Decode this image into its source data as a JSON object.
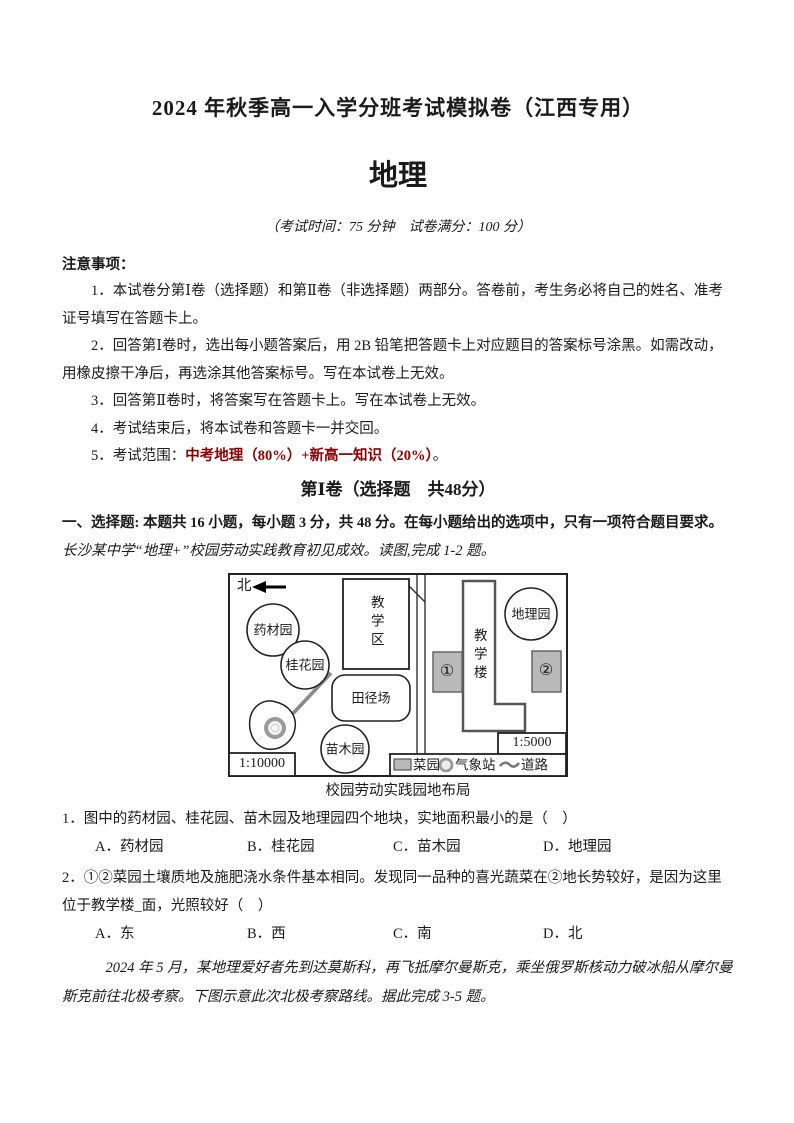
{
  "page": {
    "title": "2024 年秋季高一入学分班考试模拟卷（江西专用）",
    "subject": "地理",
    "exam_info": "（考试时间：75 分钟　试卷满分：100 分）"
  },
  "notes": {
    "heading": "注意事项：",
    "items": [
      "1．本试卷分第Ⅰ卷（选择题）和第Ⅱ卷（非选择题）两部分。答卷前，考生务必将自己的姓名、准考证号填写在答题卡上。",
      "2．回答第Ⅰ卷时，选出每小题答案后，用 2B 铅笔把答题卡上对应题目的答案标号涂黑。如需改动，用橡皮擦干净后，再选涂其他答案标号。写在本试卷上无效。",
      "3．回答第Ⅱ卷时，将答案写在答题卡上。写在本试卷上无效。",
      "4．考试结束后，将本试卷和答题卡一并交回。"
    ],
    "item5_prefix": "5．考试范围：",
    "item5_scope": "中考地理（80%）+新高一知识（20%）",
    "item5_suffix": "。",
    "scope_color": "#8b0000"
  },
  "section1": {
    "heading": "第Ⅰ卷（选择题　共48分）",
    "intro_bold": "一、选择题: 本题共 16 小题，每小题 3 分，共 48 分。在每小题给出的选项中，只有一项符合题目要求。",
    "intro_kai": "长沙某中学“地理+”校园劳动实践教育初见成效。读图,完成 1-2 题。"
  },
  "figure": {
    "caption": "校园劳动实践园地布局",
    "north_label": "北",
    "labels": {
      "yaocaiyuan": "药材园",
      "guihuayuan": "桂花园",
      "jiaoxuequ": "教学区",
      "tianjingchang": "田径场",
      "miaomuyuan": "苗木园",
      "diliyuan": "地理园",
      "jiaoxuelou": "教学楼",
      "num1": "①",
      "num2": "②",
      "scale_left": "1:10000",
      "scale_right": "1:5000"
    },
    "legend": {
      "caiyuan": "菜园",
      "qixiangzhan": "气象站",
      "daolu": "道路"
    }
  },
  "questions": [
    {
      "text": "1．图中的药材园、桂花园、苗木园及地理园四个地块，实地面积最小的是（　）",
      "options": [
        "A．药材园",
        "B．桂花园",
        "C．苗木园",
        "D．地理园"
      ]
    },
    {
      "text": "2．①②菜园土壤质地及施肥浇水条件基本相同。发现同一品种的喜光蔬菜在②地长势较好，是因为这里位于教学楼_面，光照较好（　）",
      "options": [
        "A．东",
        "B．西",
        "C．南",
        "D．北"
      ]
    }
  ],
  "closing": "2024 年 5 月，某地理爱好者先到达莫斯科，再飞抵摩尔曼斯克，乘坐俄罗斯核动力破冰船从摩尔曼斯克前往北极考察。下图示意此次北极考察路线。据此完成 3-5 题。"
}
